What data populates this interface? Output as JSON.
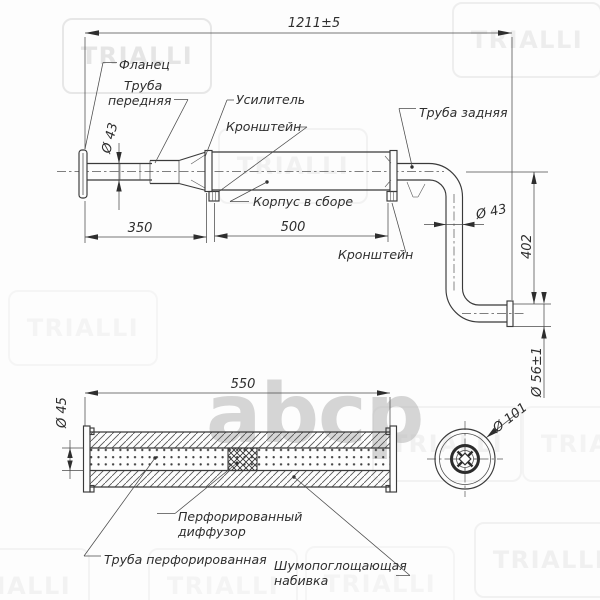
{
  "watermarks": {
    "brand": "TRIALLI",
    "logo": "abcp"
  },
  "colors": {
    "line": "#3a3a3a",
    "text": "#2e2e2e",
    "watermark": "#e0e0e0",
    "logo_gray": "#b9b9b9",
    "background": "#fdfdfd"
  },
  "side_view": {
    "dimensions": {
      "overall": "1211±5",
      "front_pipe_diameter": "Ø 43",
      "front_section_length": "350",
      "body_length": "500",
      "rear_pipe_diameter": "Ø 43",
      "drop_height": "402",
      "tip_diameter": "Ø 56±1"
    },
    "labels": {
      "flange": "Фланец",
      "front_pipe_1": "Труба",
      "front_pipe_2": "передняя",
      "reinforcement": "Усилитель",
      "bracket_front": "Кронштейн",
      "body_assembly": "Корпус в сборе",
      "rear_pipe": "Труба задняя",
      "bracket_rear": "Кронштейн"
    }
  },
  "section_view": {
    "dimensions": {
      "shell_length": "550",
      "pipe_diameter": "Ø 45",
      "shell_diameter": "Ø 101"
    },
    "labels": {
      "diffuser_1": "Перфорированный",
      "diffuser_2": "диффузор",
      "perforated_pipe": "Труба перфорированная",
      "stuffing_1": "Шумопоглощающая",
      "stuffing_2": "набивка"
    }
  }
}
